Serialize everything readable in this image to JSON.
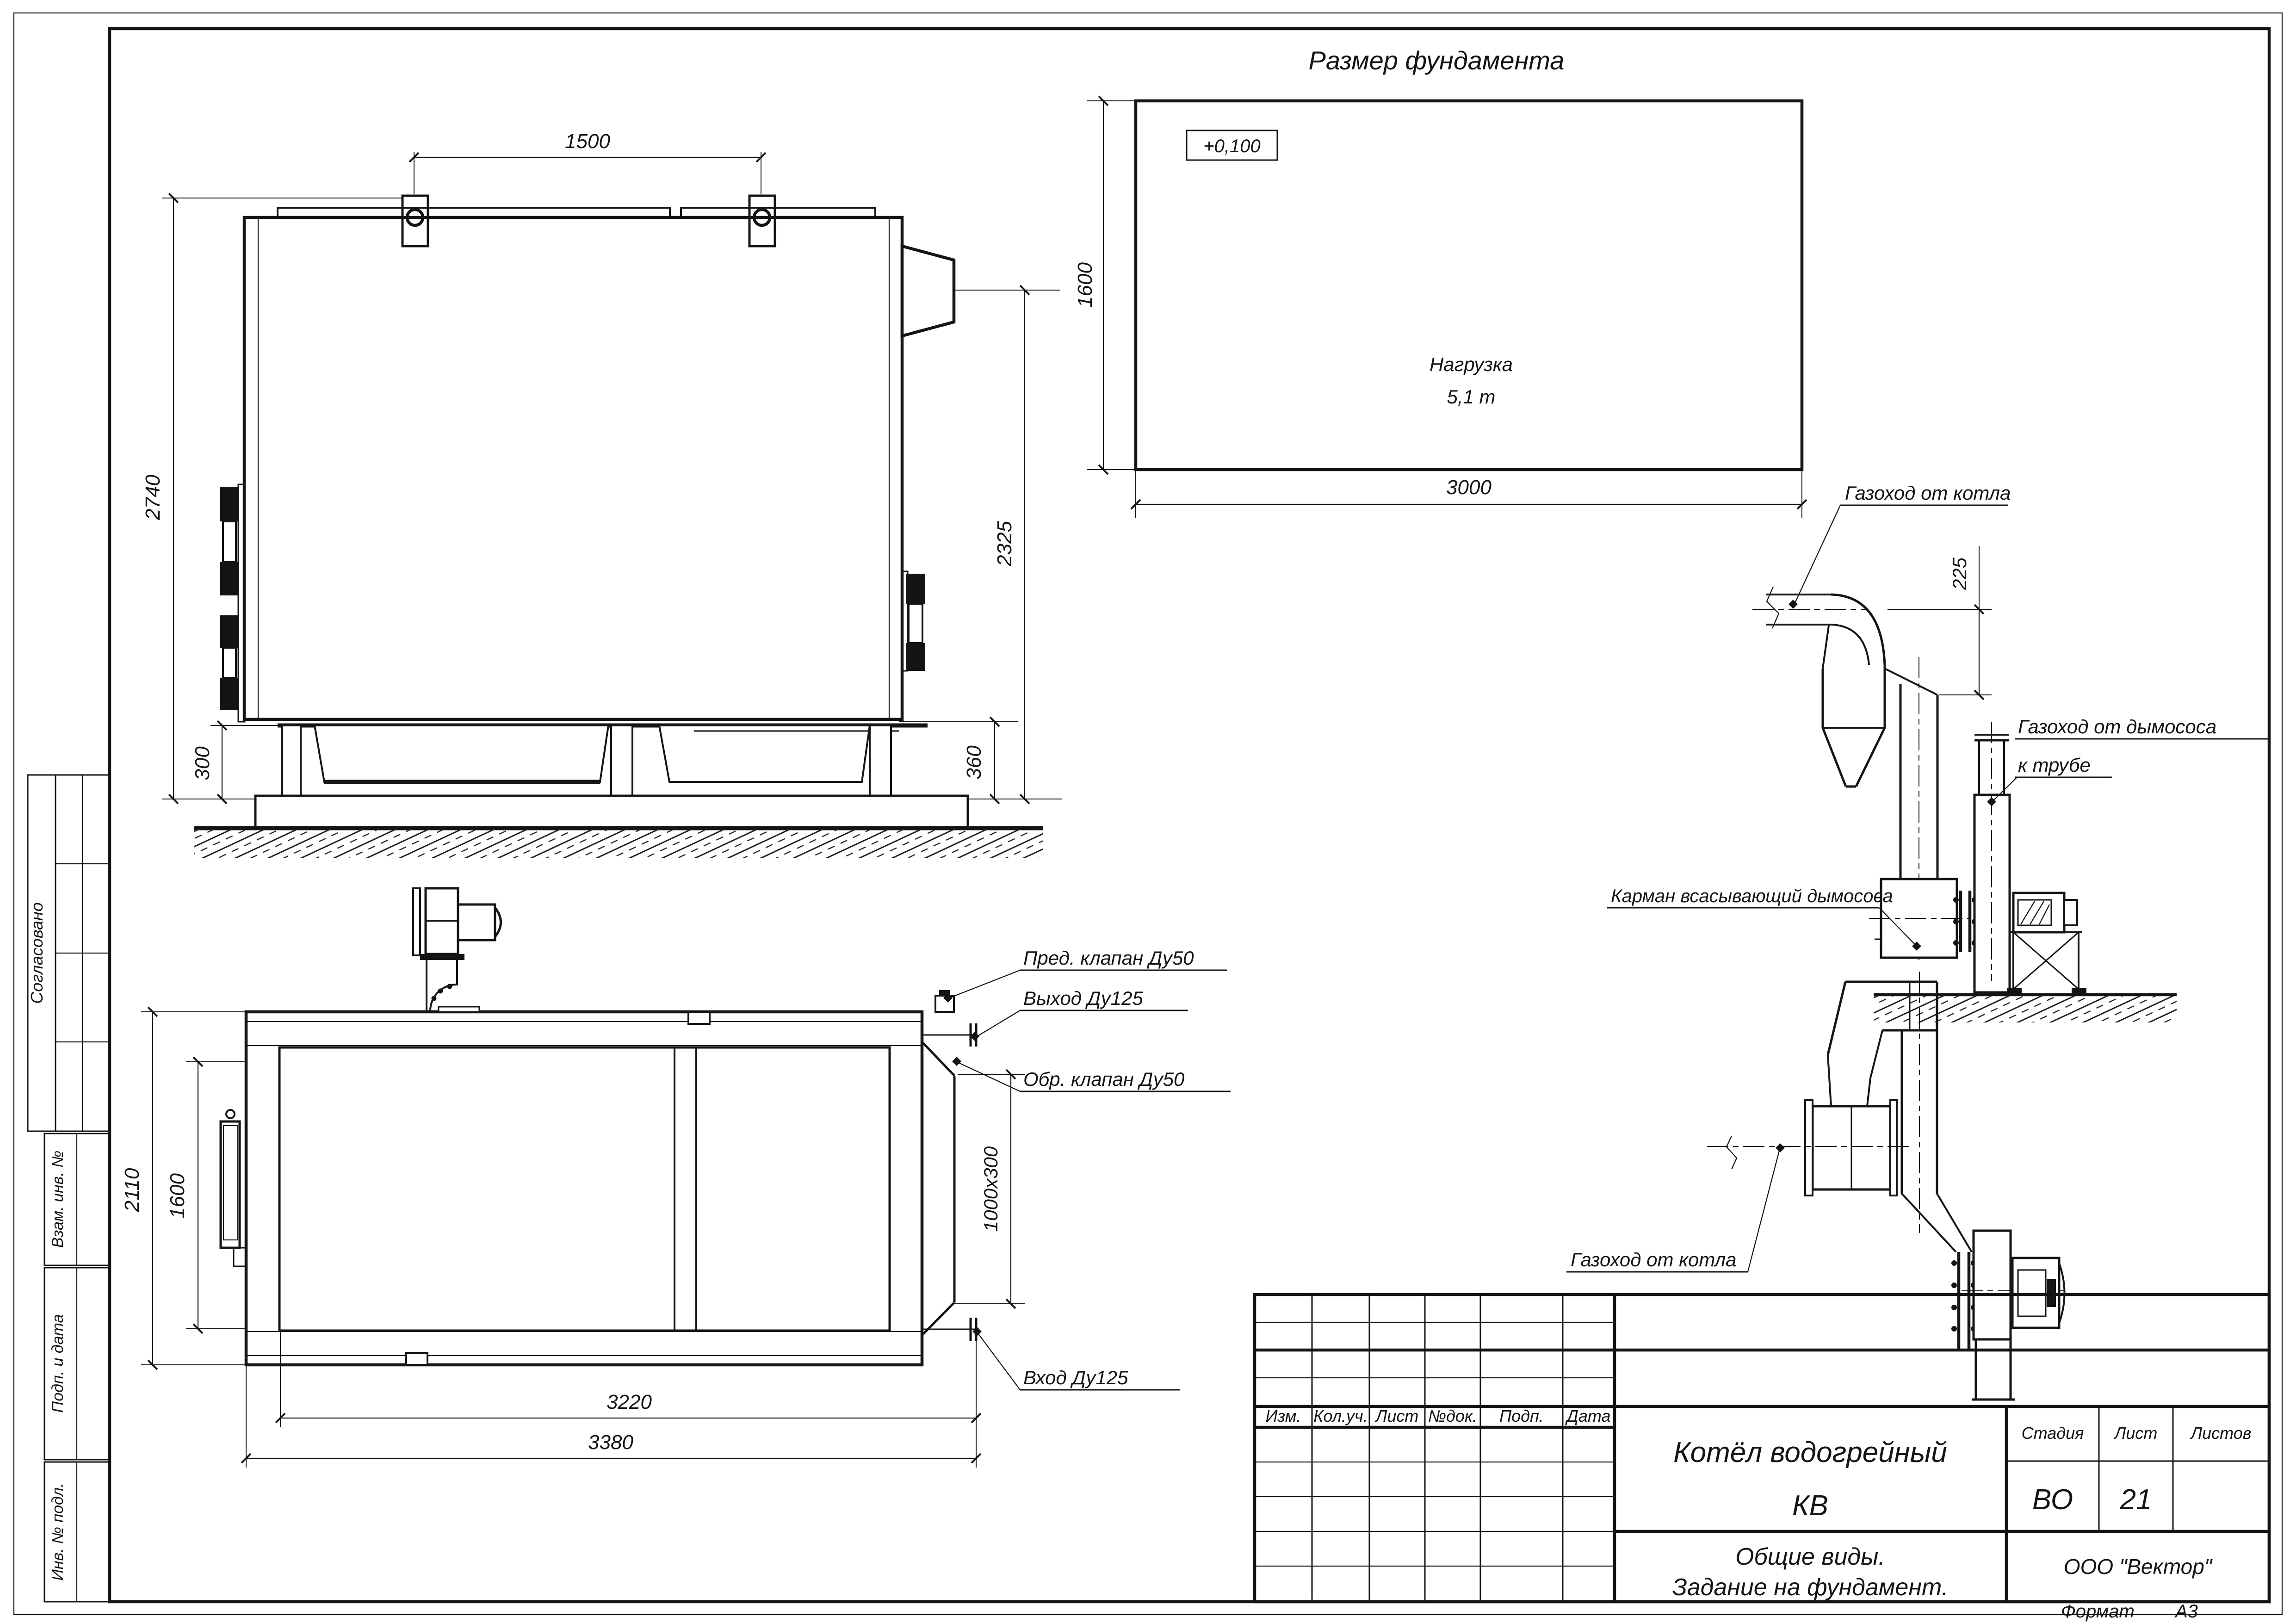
{
  "sheet": {
    "foundation_title": "Размер фундамента",
    "format_label": "Формат",
    "format_value": "А3"
  },
  "foundation": {
    "elevation_mark": "+0,100",
    "load_label": "Нагрузка",
    "load_value": "5,1 т",
    "dim_width": "3000",
    "dim_height": "1600"
  },
  "side_view": {
    "dim_lugs": "1500",
    "dim_height": "2740",
    "dim_flue": "2325",
    "dim_frame_left": "300",
    "dim_frame_right": "360"
  },
  "plan_view": {
    "dim_width_total": "2110",
    "dim_width_inner": "1600",
    "dim_length_inner": "3220",
    "dim_length_total": "3380",
    "dim_duct": "1000х300",
    "callout_safety_valve": "Пред. клапан Ду50",
    "callout_outlet": "Выход Ду125",
    "callout_check_valve": "Обр. клапан Ду50",
    "callout_inlet": "Вход Ду125"
  },
  "gas_duct_elevation": {
    "label_from_boiler": "Газоход от котла",
    "dim_offset": "225",
    "label_to_stack_line1": "Газоход от дымососа",
    "label_to_stack_line2": "к трубе",
    "label_pocket": "Карман всасывающий дымососа"
  },
  "gas_duct_plan": {
    "label_from_boiler": "Газоход от котла"
  },
  "title_block": {
    "doc_name_line1": "Котёл водогрейный",
    "doc_name_line2": "КВ",
    "doc_type_line1": "Общие виды.",
    "doc_type_line2": "Задание на фундамент.",
    "company": "ООО \"Вектор\"",
    "stage_label": "Стадия",
    "sheet_label": "Лист",
    "sheets_label": "Листов",
    "stage_value": "ВО",
    "sheet_value": "21",
    "rev_headers": [
      "Изм.",
      "Кол.уч.",
      "Лист",
      "№док.",
      "Подп.",
      "Дата"
    ]
  },
  "margin_stamps": {
    "approved": "Согласовано",
    "replace_inv": "Взам. инв. №",
    "sign_date": "Подп. и дата",
    "inv_orig": "Инв. № подл."
  }
}
